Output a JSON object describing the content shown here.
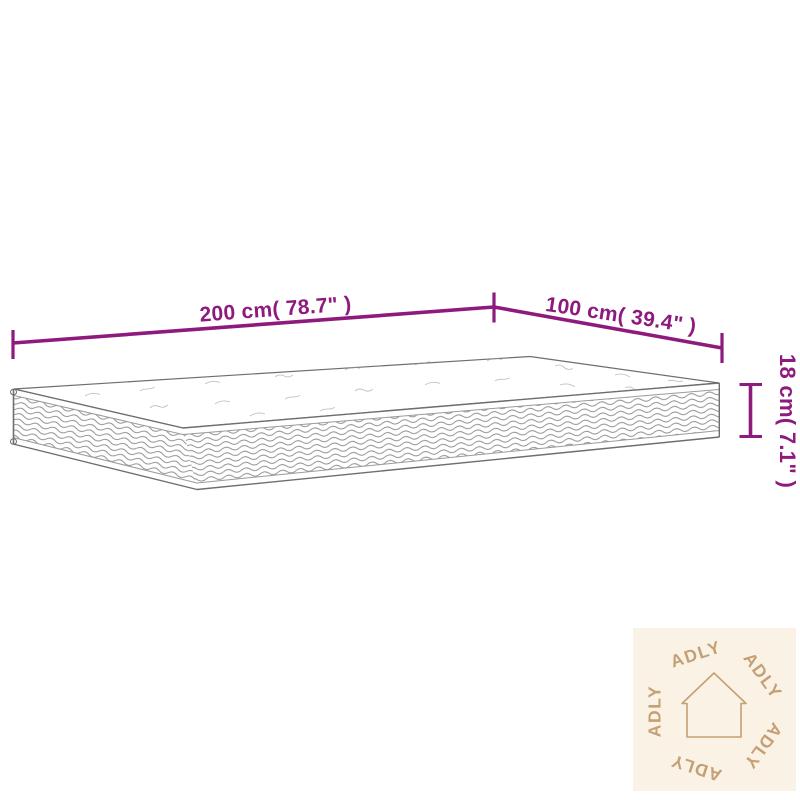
{
  "theme": {
    "accent": "#8E1A7E",
    "line": "#6E6E6E",
    "line_soft": "#9A9A9A",
    "tan": "#C4A075",
    "watermark_bg": "#FBF2E6"
  },
  "diagram": {
    "kind": "mattress-dimension-diagram",
    "dimensions": {
      "length_label": "200 cm( 78.7\" )",
      "width_label": "100 cm( 39.4\" )",
      "height_label": "18 cm( 7.1\" )"
    }
  },
  "watermark": {
    "brand": "ADLY",
    "icon": "house-icon",
    "repeat_count": 5
  }
}
